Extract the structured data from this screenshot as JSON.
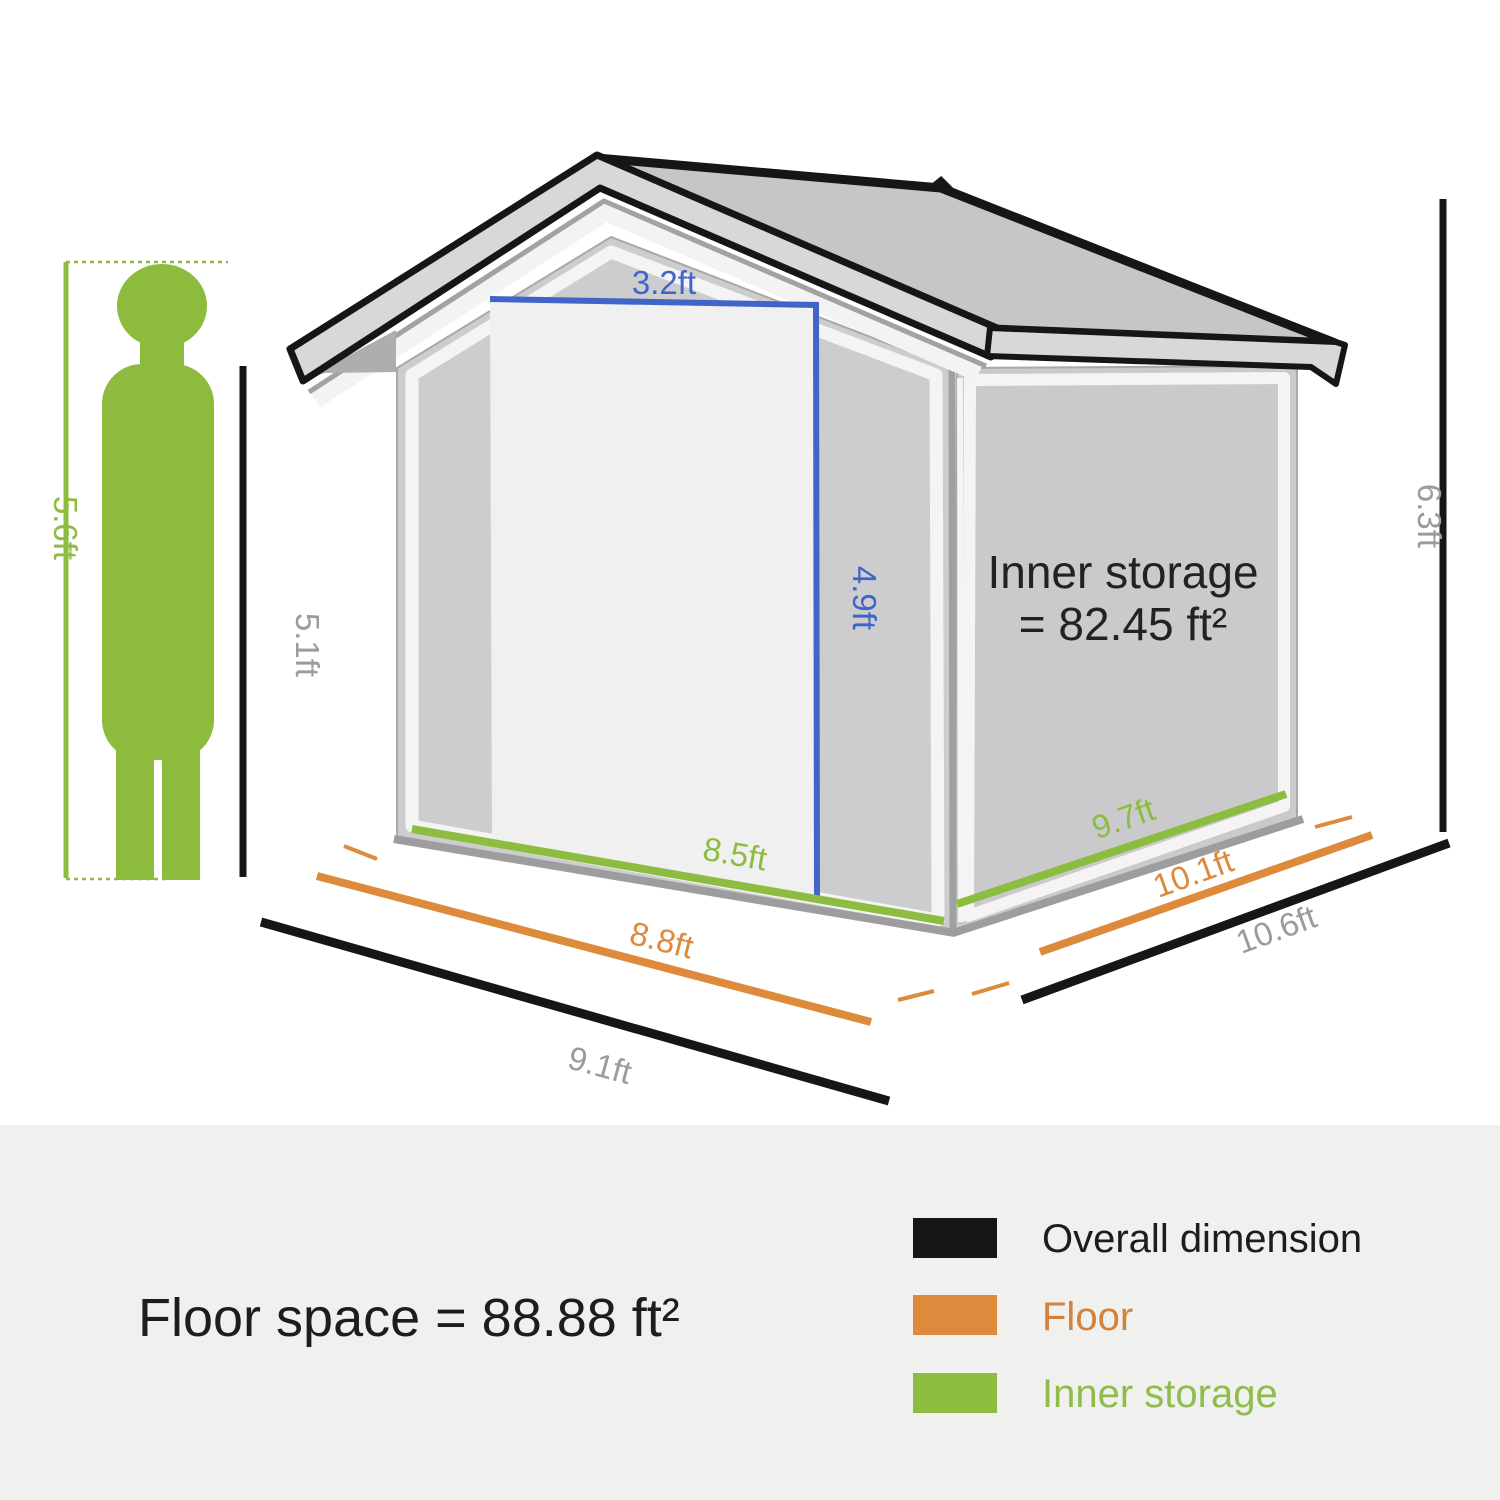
{
  "colors": {
    "overall": "#161616",
    "floor": "#dd8a3c",
    "inner": "#8cbd40",
    "door": "#4064c8",
    "label_gray": "#9b9b9b",
    "text_dark": "#1d1d1d",
    "panel_bg": "#f0f0ee",
    "person": "#8dbb3e"
  },
  "dims": {
    "person_height": "5.6ft",
    "wall_height": "5.1ft",
    "overall_height": "6.3ft",
    "door_width": "3.2ft",
    "door_height": "4.9ft",
    "inner_width": "8.5ft",
    "floor_width": "8.8ft",
    "overall_width": "9.1ft",
    "inner_depth": "9.7ft",
    "floor_depth": "10.1ft",
    "overall_depth": "10.6ft"
  },
  "shed": {
    "inner_storage_line1": "Inner storage",
    "inner_storage_line2": "= 82.45 ft²"
  },
  "footer": {
    "floor_space": "Floor space = 88.88 ft²"
  },
  "legend": {
    "items": [
      {
        "label": "Overall dimension",
        "color": "#161616",
        "text_color": "#1d1d1d"
      },
      {
        "label": "Floor",
        "color": "#dd8a3c",
        "text_color": "#d2823d"
      },
      {
        "label": "Inner storage",
        "color": "#8cbd40",
        "text_color": "#8fbc4a"
      }
    ]
  }
}
